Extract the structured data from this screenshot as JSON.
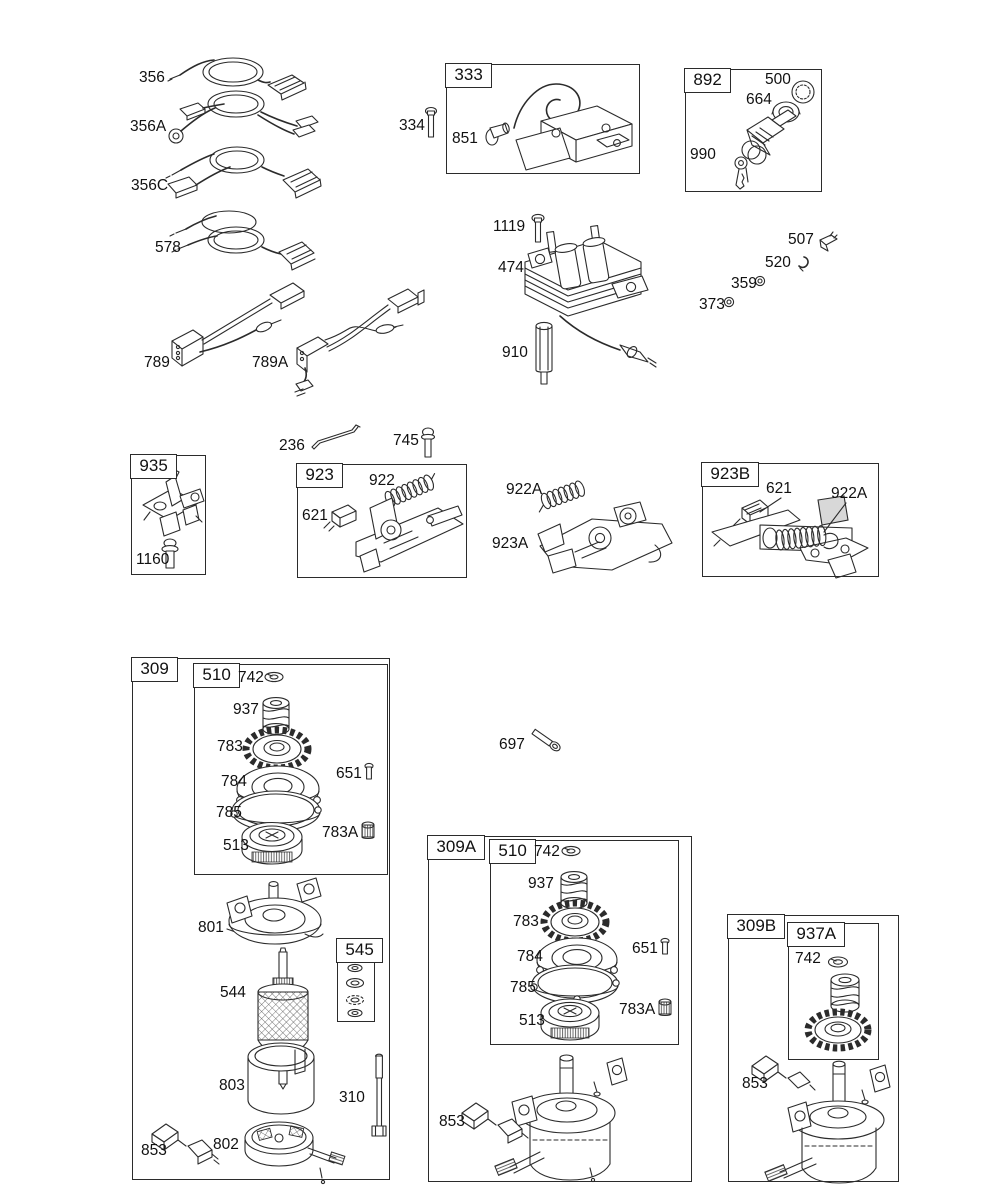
{
  "page": {
    "background": "#ffffff",
    "line_color": "#2b2b2b",
    "diagram_type": "engine-starter-and-ignition-parts-diagram"
  },
  "boxes": [
    {
      "id": "333",
      "label": "333",
      "x": 446,
      "y": 64,
      "w": 192,
      "h": 108
    },
    {
      "id": "892",
      "label": "892",
      "x": 685,
      "y": 69,
      "w": 135,
      "h": 121
    },
    {
      "id": "935",
      "label": "935",
      "x": 131,
      "y": 455,
      "w": 73,
      "h": 118
    },
    {
      "id": "923",
      "label": "923",
      "x": 297,
      "y": 464,
      "w": 168,
      "h": 112
    },
    {
      "id": "923B",
      "label": "923B",
      "x": 702,
      "y": 463,
      "w": 175,
      "h": 112
    },
    {
      "id": "309",
      "label": "309",
      "x": 132,
      "y": 658,
      "w": 256,
      "h": 520
    },
    {
      "id": "510a",
      "label": "510",
      "x": 194,
      "y": 664,
      "w": 192,
      "h": 209
    },
    {
      "id": "545",
      "label": "545",
      "x": 337,
      "y": 939,
      "w": 36,
      "h": 81
    },
    {
      "id": "309A",
      "label": "309A",
      "x": 428,
      "y": 836,
      "w": 262,
      "h": 344
    },
    {
      "id": "510b",
      "label": "510",
      "x": 490,
      "y": 840,
      "w": 187,
      "h": 203
    },
    {
      "id": "309B",
      "label": "309B",
      "x": 728,
      "y": 915,
      "w": 169,
      "h": 265
    },
    {
      "id": "937A",
      "label": "937A",
      "x": 788,
      "y": 923,
      "w": 89,
      "h": 135
    }
  ],
  "callouts": [
    {
      "id": "356",
      "text": "356",
      "x": 139,
      "y": 70
    },
    {
      "id": "356A",
      "text": "356A",
      "x": 130,
      "y": 119
    },
    {
      "id": "356C",
      "text": "356C",
      "x": 131,
      "y": 178
    },
    {
      "id": "578",
      "text": "578",
      "x": 155,
      "y": 240
    },
    {
      "id": "334",
      "text": "334",
      "x": 399,
      "y": 118
    },
    {
      "id": "851",
      "text": "851",
      "x": 452,
      "y": 131
    },
    {
      "id": "500",
      "text": "500",
      "x": 765,
      "y": 72
    },
    {
      "id": "664",
      "text": "664",
      "x": 746,
      "y": 92
    },
    {
      "id": "990",
      "text": "990",
      "x": 690,
      "y": 147
    },
    {
      "id": "1119",
      "text": "1119",
      "x": 493,
      "y": 219
    },
    {
      "id": "474",
      "text": "474",
      "x": 498,
      "y": 260
    },
    {
      "id": "910",
      "text": "910",
      "x": 502,
      "y": 345
    },
    {
      "id": "507",
      "text": "507",
      "x": 788,
      "y": 232
    },
    {
      "id": "520",
      "text": "520",
      "x": 765,
      "y": 255
    },
    {
      "id": "359",
      "text": "359",
      "x": 731,
      "y": 276
    },
    {
      "id": "373",
      "text": "373",
      "x": 699,
      "y": 297
    },
    {
      "id": "789",
      "text": "789",
      "x": 144,
      "y": 355
    },
    {
      "id": "789A",
      "text": "789A",
      "x": 252,
      "y": 355
    },
    {
      "id": "236",
      "text": "236",
      "x": 279,
      "y": 438
    },
    {
      "id": "745",
      "text": "745",
      "x": 393,
      "y": 433
    },
    {
      "id": "1160",
      "text": "1160",
      "x": 136,
      "y": 552
    },
    {
      "id": "922",
      "text": "922",
      "x": 369,
      "y": 473
    },
    {
      "id": "621a",
      "text": "621",
      "x": 302,
      "y": 508
    },
    {
      "id": "922A1",
      "text": "922A",
      "x": 506,
      "y": 482
    },
    {
      "id": "923A",
      "text": "923A",
      "x": 492,
      "y": 536
    },
    {
      "id": "621b",
      "text": "621",
      "x": 766,
      "y": 481
    },
    {
      "id": "922A2",
      "text": "922A",
      "x": 831,
      "y": 486
    },
    {
      "id": "742a",
      "text": "742",
      "x": 238,
      "y": 670
    },
    {
      "id": "937a",
      "text": "937",
      "x": 233,
      "y": 702
    },
    {
      "id": "783a",
      "text": "783",
      "x": 217,
      "y": 739
    },
    {
      "id": "784a",
      "text": "784",
      "x": 221,
      "y": 774
    },
    {
      "id": "785a",
      "text": "785",
      "x": 216,
      "y": 805
    },
    {
      "id": "513a",
      "text": "513",
      "x": 223,
      "y": 838
    },
    {
      "id": "651a",
      "text": "651",
      "x": 336,
      "y": 766
    },
    {
      "id": "783Aa",
      "text": "783A",
      "x": 322,
      "y": 825
    },
    {
      "id": "697",
      "text": "697",
      "x": 499,
      "y": 737
    },
    {
      "id": "801",
      "text": "801",
      "x": 198,
      "y": 920
    },
    {
      "id": "544",
      "text": "544",
      "x": 220,
      "y": 985
    },
    {
      "id": "803",
      "text": "803",
      "x": 219,
      "y": 1078
    },
    {
      "id": "310",
      "text": "310",
      "x": 339,
      "y": 1090
    },
    {
      "id": "802",
      "text": "802",
      "x": 213,
      "y": 1137
    },
    {
      "id": "853a",
      "text": "853",
      "x": 141,
      "y": 1143
    },
    {
      "id": "742b",
      "text": "742",
      "x": 534,
      "y": 844
    },
    {
      "id": "937b",
      "text": "937",
      "x": 528,
      "y": 876
    },
    {
      "id": "783b",
      "text": "783",
      "x": 513,
      "y": 914
    },
    {
      "id": "784b",
      "text": "784",
      "x": 517,
      "y": 949
    },
    {
      "id": "785b",
      "text": "785",
      "x": 510,
      "y": 980
    },
    {
      "id": "513b",
      "text": "513",
      "x": 519,
      "y": 1013
    },
    {
      "id": "651b",
      "text": "651",
      "x": 632,
      "y": 941
    },
    {
      "id": "783Ab",
      "text": "783A",
      "x": 619,
      "y": 1002
    },
    {
      "id": "853b",
      "text": "853",
      "x": 439,
      "y": 1114
    },
    {
      "id": "742c",
      "text": "742",
      "x": 795,
      "y": 951
    },
    {
      "id": "853c",
      "text": "853",
      "x": 742,
      "y": 1076
    }
  ]
}
